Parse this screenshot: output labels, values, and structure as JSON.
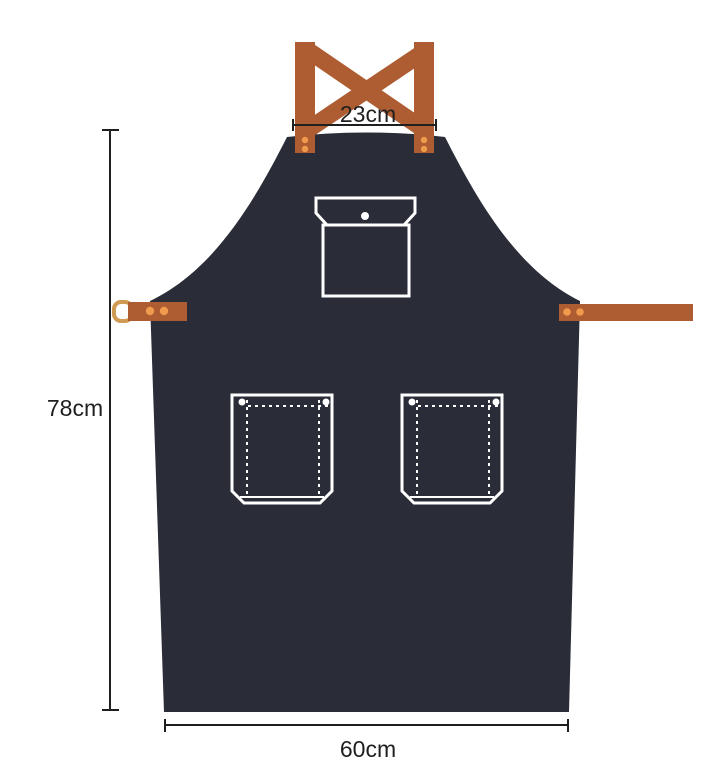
{
  "dimensions": {
    "neck_strap_width": "23cm",
    "body_height": "78cm",
    "bottom_width": "60cm"
  },
  "colors": {
    "background": "#ffffff",
    "apron_body": "#2a2c37",
    "strap": "#ae5c31",
    "rivet": "#f09a4e",
    "d_ring": "#cf9a52",
    "pocket_outline": "#ffffff",
    "dimension": "#1f1f1f"
  }
}
